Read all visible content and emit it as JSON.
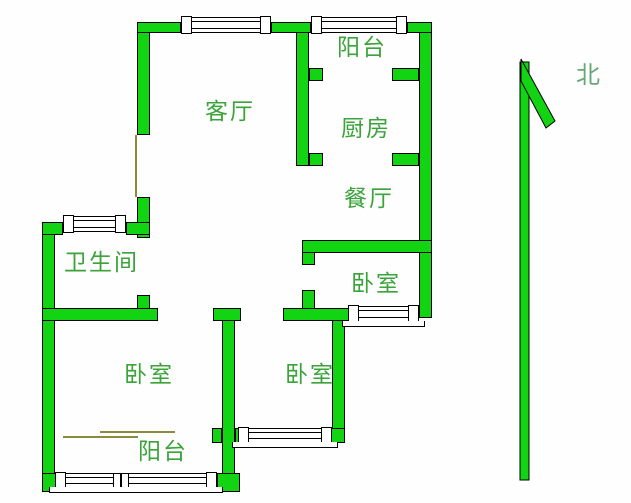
{
  "colors": {
    "background": "#fefefe",
    "wall_fill": "#12d412",
    "wall_border": "#000000",
    "label_text": "#3aa43a",
    "north_text": "#68a878",
    "door_line": "#8b8b3d"
  },
  "compass": {
    "label": "北"
  },
  "rooms": [
    {
      "id": "living-room",
      "label": "客厅",
      "x": 205,
      "y": 100
    },
    {
      "id": "balcony-north",
      "label": "阳台",
      "x": 337,
      "y": 36
    },
    {
      "id": "kitchen",
      "label": "厨房",
      "x": 341,
      "y": 117
    },
    {
      "id": "dining-room",
      "label": "餐厅",
      "x": 344,
      "y": 187
    },
    {
      "id": "bathroom",
      "label": "卫生间",
      "x": 64,
      "y": 251
    },
    {
      "id": "bedroom-east",
      "label": "卧室",
      "x": 351,
      "y": 272
    },
    {
      "id": "bedroom-west",
      "label": "卧室",
      "x": 124,
      "y": 363
    },
    {
      "id": "bedroom-south",
      "label": "卧室",
      "x": 285,
      "y": 363
    },
    {
      "id": "balcony-south",
      "label": "阳台",
      "x": 138,
      "y": 440
    }
  ],
  "geometry": {
    "walls": [
      {
        "x": 137,
        "y": 22,
        "w": 13,
        "h": 113
      },
      {
        "x": 137,
        "y": 197,
        "w": 13,
        "h": 41
      },
      {
        "x": 137,
        "y": 295,
        "w": 13,
        "h": 26
      },
      {
        "x": 296,
        "y": 22,
        "w": 13,
        "h": 144
      },
      {
        "x": 302,
        "y": 248,
        "w": 13,
        "h": 17
      },
      {
        "x": 302,
        "y": 290,
        "w": 13,
        "h": 31
      },
      {
        "x": 419,
        "y": 22,
        "w": 13,
        "h": 296
      },
      {
        "x": 222,
        "y": 308,
        "w": 13,
        "h": 179
      },
      {
        "x": 332,
        "y": 312,
        "w": 13,
        "h": 131
      },
      {
        "x": 42,
        "y": 222,
        "w": 13,
        "h": 270
      },
      {
        "x": 137,
        "y": 22,
        "w": 44,
        "h": 11
      },
      {
        "x": 271,
        "y": 22,
        "w": 40,
        "h": 11
      },
      {
        "x": 407,
        "y": 22,
        "w": 25,
        "h": 11
      },
      {
        "x": 309,
        "y": 68,
        "w": 14,
        "h": 13
      },
      {
        "x": 392,
        "y": 68,
        "w": 27,
        "h": 13
      },
      {
        "x": 309,
        "y": 153,
        "w": 14,
        "h": 13
      },
      {
        "x": 392,
        "y": 153,
        "w": 27,
        "h": 13
      },
      {
        "x": 302,
        "y": 240,
        "w": 130,
        "h": 13
      },
      {
        "x": 42,
        "y": 222,
        "w": 21,
        "h": 13
      },
      {
        "x": 126,
        "y": 222,
        "w": 24,
        "h": 13
      },
      {
        "x": 42,
        "y": 308,
        "w": 116,
        "h": 13
      },
      {
        "x": 213,
        "y": 308,
        "w": 28,
        "h": 13
      },
      {
        "x": 283,
        "y": 308,
        "w": 70,
        "h": 13
      },
      {
        "x": 212,
        "y": 428,
        "w": 10,
        "h": 15
      },
      {
        "x": 235,
        "y": 428,
        "w": 12,
        "h": 15
      },
      {
        "x": 323,
        "y": 428,
        "w": 22,
        "h": 15
      },
      {
        "x": 42,
        "y": 473,
        "w": 18,
        "h": 19
      },
      {
        "x": 217,
        "y": 473,
        "w": 23,
        "h": 19
      }
    ],
    "windows": [
      {
        "x": 181,
        "y": 17,
        "w": 90,
        "h": 16
      },
      {
        "x": 311,
        "y": 17,
        "w": 96,
        "h": 16
      },
      {
        "x": 63,
        "y": 216,
        "w": 63,
        "h": 16
      },
      {
        "x": 348,
        "y": 306,
        "w": 71,
        "h": 16,
        "sill": "bottom"
      },
      {
        "x": 238,
        "y": 428,
        "w": 94,
        "h": 15,
        "sill": "bottom"
      },
      {
        "x": 55,
        "y": 473,
        "w": 162,
        "h": 15,
        "sill": "bottom",
        "mullion": true
      }
    ],
    "doors": [
      {
        "x": 135,
        "y": 135,
        "w": 2,
        "h": 62
      },
      {
        "x": 100,
        "y": 431,
        "w": 75,
        "h": 2
      },
      {
        "x": 63,
        "y": 436,
        "w": 75,
        "h": 2
      }
    ]
  }
}
